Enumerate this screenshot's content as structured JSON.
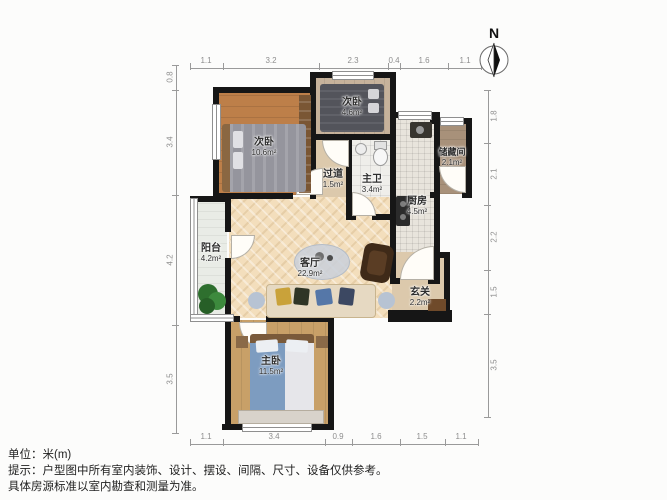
{
  "compass": {
    "label": "N"
  },
  "rooms": [
    {
      "name": "bedroom-second-left",
      "label": "次卧",
      "area": "10.6m²"
    },
    {
      "name": "bedroom-second-top",
      "label": "次卧",
      "area": "4.6m²"
    },
    {
      "name": "hallway",
      "label": "过道",
      "area": "1.5m²"
    },
    {
      "name": "master-bathroom",
      "label": "主卫",
      "area": "3.4m²"
    },
    {
      "name": "kitchen",
      "label": "厨房",
      "area": "4.5m²"
    },
    {
      "name": "storage-room",
      "label": "储藏间",
      "area": "2.1m²"
    },
    {
      "name": "balcony",
      "label": "阳台",
      "area": "4.2m²"
    },
    {
      "name": "living-room",
      "label": "客厅",
      "area": "22.9m²"
    },
    {
      "name": "entry",
      "label": "玄关",
      "area": "2.2m²"
    },
    {
      "name": "master-bedroom",
      "label": "主卧",
      "area": "11.5m²"
    }
  ],
  "dimensions": {
    "top": [
      "1.1",
      "3.2",
      "2.3",
      "0.4",
      "1.6",
      "1.1"
    ],
    "bottom": [
      "1.1",
      "3.4",
      "0.9",
      "1.6",
      "1.5",
      "1.1"
    ],
    "left": [
      "0.8",
      "3.4",
      "4.2",
      "3.5"
    ],
    "right": [
      "1.8",
      "2.1",
      "2.2",
      "1.5",
      "3.5"
    ]
  },
  "footer": {
    "unit_line": "单位：米(m)",
    "hint_line1": "提示：户型图中所有室内装饰、设计、摆设、间隔、尺寸、设备仅供参考。",
    "hint_line2": "具体房源标准以室内勘查和测量为准。"
  },
  "colors": {
    "wall": "#161616",
    "living_floor": "#f3debc",
    "wood_floor": "#bd7f49",
    "plant_green": "#2e6f2e",
    "sofa_blue_pillow": "#5577a8",
    "dim_text": "#8e8e8e"
  }
}
